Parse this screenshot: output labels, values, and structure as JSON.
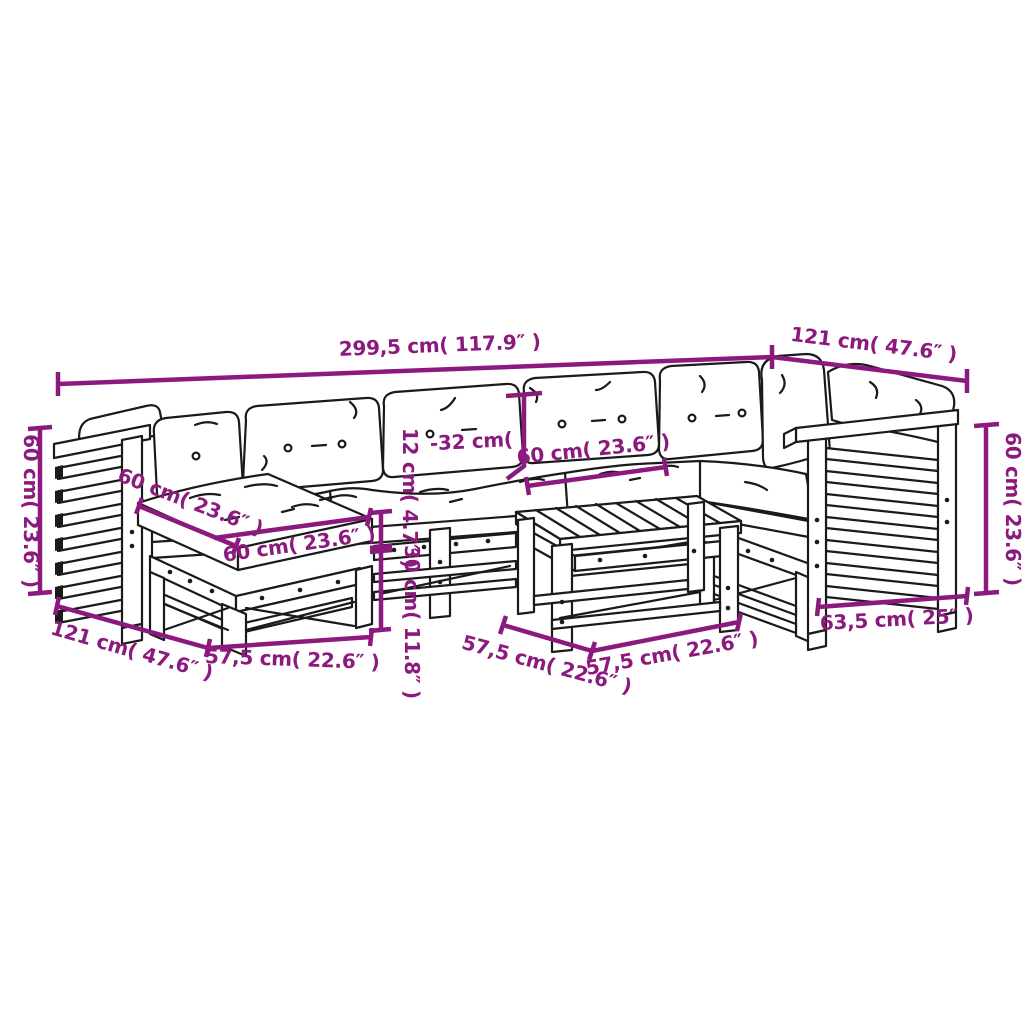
{
  "colors": {
    "dimension": "#8C1A7E",
    "line_art": "#1a1a1a",
    "background": "#ffffff"
  },
  "labels": {
    "total_width": "299,5 cm( 117.9″ )",
    "corner_width": "121 cm( 47.6″ )",
    "left_arm_height": "60 cm( 23.6″ )",
    "right_arm_height": "60 cm( 23.6″ )",
    "back_cushion_height": "-32 cm(",
    "seat_width": "60 cm( 23.6″ )",
    "ottoman_cushion_depth": "60 cm( 23.6″ )",
    "ottoman_cushion_width": "60 cm( 23.6″ )",
    "seat_cushion_thickness": "12 cm( 4.7″ )",
    "frame_height": "30 cm( 11.8″ )",
    "module_depth": "121 cm( 47.6″ )",
    "ottoman_frame_width": "57,5 cm( 22.6″ )",
    "table_depth": "57,5 cm( 22.6″ )",
    "table_width": "57,5 cm( 22.6″ )",
    "arm_module_width": "63,5 cm( 25″ )"
  }
}
